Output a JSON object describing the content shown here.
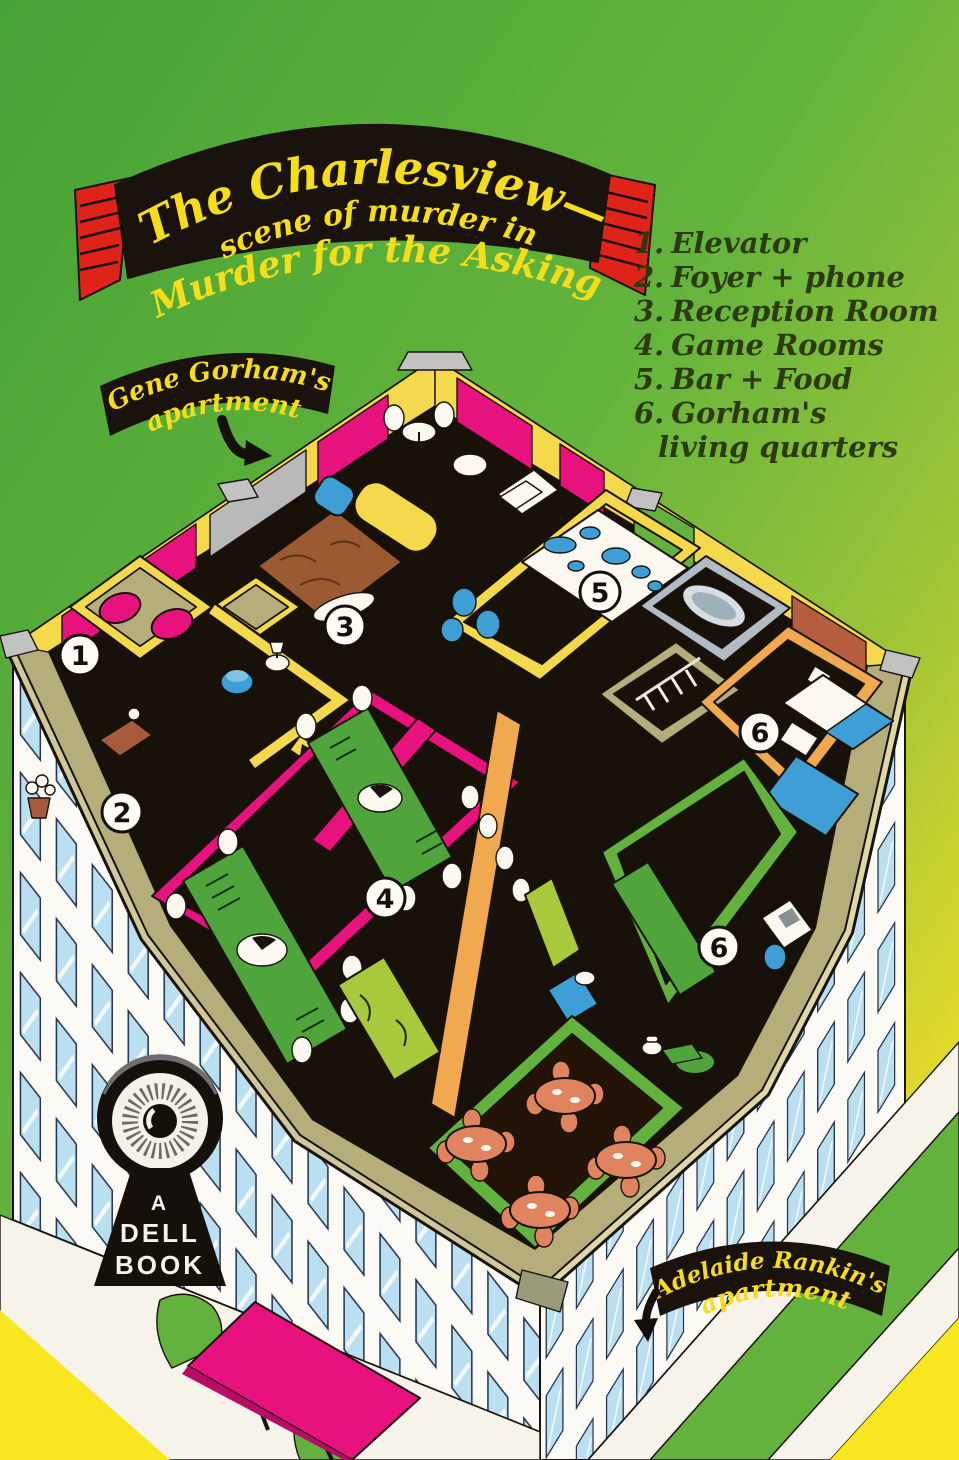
{
  "banner": {
    "line1": "The Charlesview—",
    "line2": "scene of murder in",
    "line3": "\"Murder for the Asking\""
  },
  "legend": {
    "items": [
      {
        "number": "1.",
        "label": "Elevator"
      },
      {
        "number": "2.",
        "label": "Foyer + phone"
      },
      {
        "number": "3.",
        "label": "Reception Room"
      },
      {
        "number": "4.",
        "label": "Game Rooms"
      },
      {
        "number": "5.",
        "label": "Bar + Food"
      },
      {
        "number": "6.",
        "label": "Gorham's",
        "label2": "living quarters"
      }
    ]
  },
  "callouts": {
    "gorham": {
      "line1": "Gene Gorham's",
      "line2": "apartment"
    },
    "rankin": {
      "line1": "Adelaide Rankin's",
      "line2": "apartment"
    }
  },
  "publisher": {
    "line1": "A",
    "line2": "DELL",
    "line3": "BOOK"
  },
  "map": {
    "markers": [
      {
        "label": "1"
      },
      {
        "label": "2"
      },
      {
        "label": "3"
      },
      {
        "label": "4"
      },
      {
        "label": "5"
      },
      {
        "label": "6"
      },
      {
        "label": "6"
      }
    ]
  },
  "colors": {
    "bg-green": "#4fab38",
    "bg-yellow": "#f8e71f",
    "ribbon-red": "#df2318",
    "banner-black": "#1a130d",
    "lettering-yellow": "#f6dd1c",
    "legend-ink": "#2c3a12",
    "wall-yellow": "#f5d94d",
    "wall-magenta": "#e8127f",
    "wall-green": "#62b23d",
    "wall-orange": "#f0a94f",
    "floor-black": "#181109",
    "parapet-khaki": "#b5ae7a",
    "window-blue": "#b9dff0",
    "furniture-blue": "#3d9fd6",
    "furniture-green": "#4fa53b",
    "furniture-chartreuse": "#a9c93d",
    "table-salmon": "#e0835f",
    "rug-brown": "#9c5a32"
  }
}
